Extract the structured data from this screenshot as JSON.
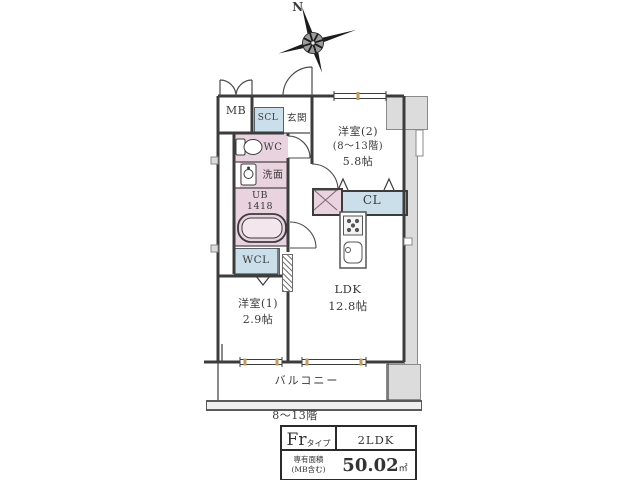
{
  "compass": {
    "north": "N"
  },
  "rooms": {
    "mb": "MB",
    "scl": "SCL",
    "genkan": "玄関",
    "wc": "WC",
    "senmen": "洗面",
    "ub_line1": "UB",
    "ub_line2": "1418",
    "wcl": "WCL",
    "yoshitsu2_name": "洋室(2)",
    "yoshitsu2_floors": "(8～13階)",
    "yoshitsu2_size": "5.8帖",
    "cl": "CL",
    "ldk_name": "LDK",
    "ldk_size": "12.8帖",
    "yoshitsu1_name": "洋室(1)",
    "yoshitsu1_size": "2.9帖",
    "balcony": "バルコニー"
  },
  "floor_note": "8～13階",
  "info_table": {
    "type_value": "Fr",
    "type_suffix": "タイプ",
    "layout": "2LDK",
    "area_label_line1": "専有面積",
    "area_label_line2": "(MB含む)",
    "area_value": "50.02",
    "area_unit": "㎡"
  },
  "colors": {
    "wet_area_pink": "#e9d3de",
    "storage_blue": "#cadfe9",
    "structure_gray": "#dcdcdc"
  }
}
